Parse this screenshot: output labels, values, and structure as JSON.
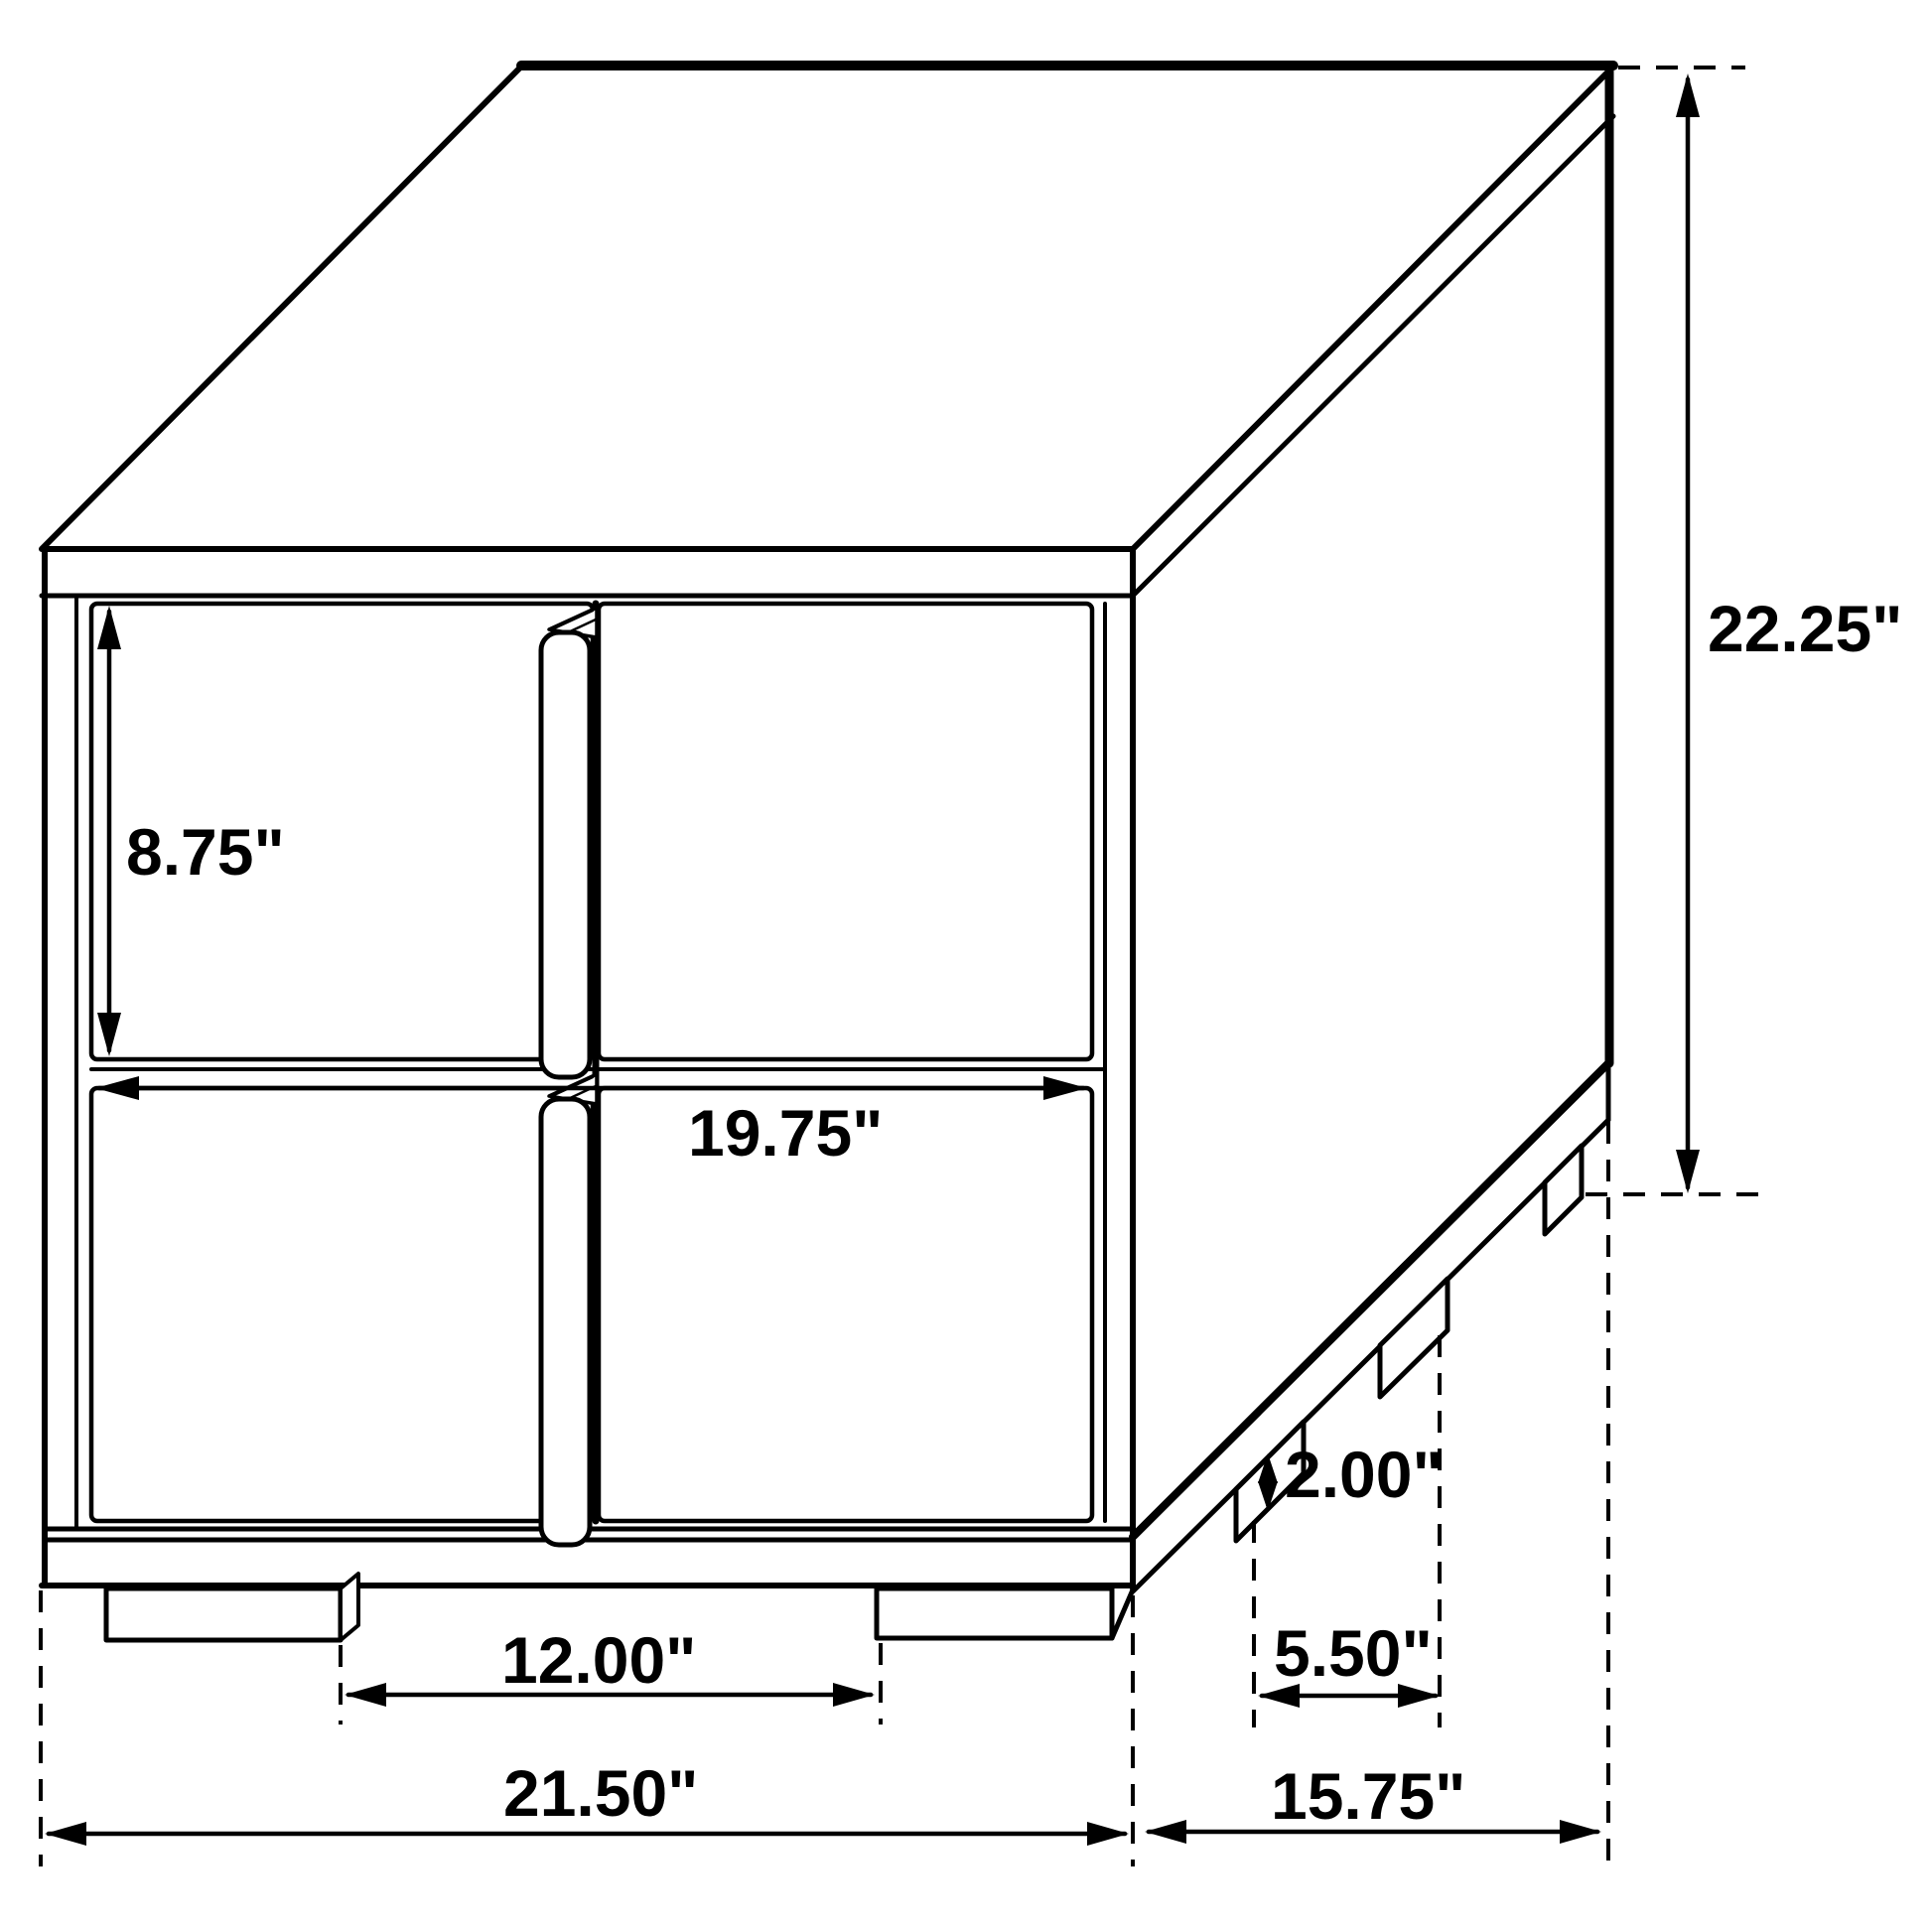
{
  "page": {
    "background_color": "#ffffff",
    "line_color": "#000000"
  },
  "drawing": {
    "subject": "two-drawer nightstand isometric dimension drawing",
    "unit": "inches"
  },
  "dimensions": {
    "drawer_height": {
      "label": "8.75\"",
      "value": 8.75
    },
    "drawer_width": {
      "label": "19.75\"",
      "value": 19.75
    },
    "overall_height": {
      "label": "22.25\"",
      "value": 22.25
    },
    "foot_height": {
      "label": "2.00\"",
      "value": 2.0
    },
    "front_feet_gap": {
      "label": "12.00\"",
      "value": 12.0
    },
    "side_feet_gap": {
      "label": "5.50\"",
      "value": 5.5
    },
    "overall_width": {
      "label": "21.50\"",
      "value": 21.5
    },
    "overall_depth": {
      "label": "15.75\"",
      "value": 15.75
    }
  }
}
